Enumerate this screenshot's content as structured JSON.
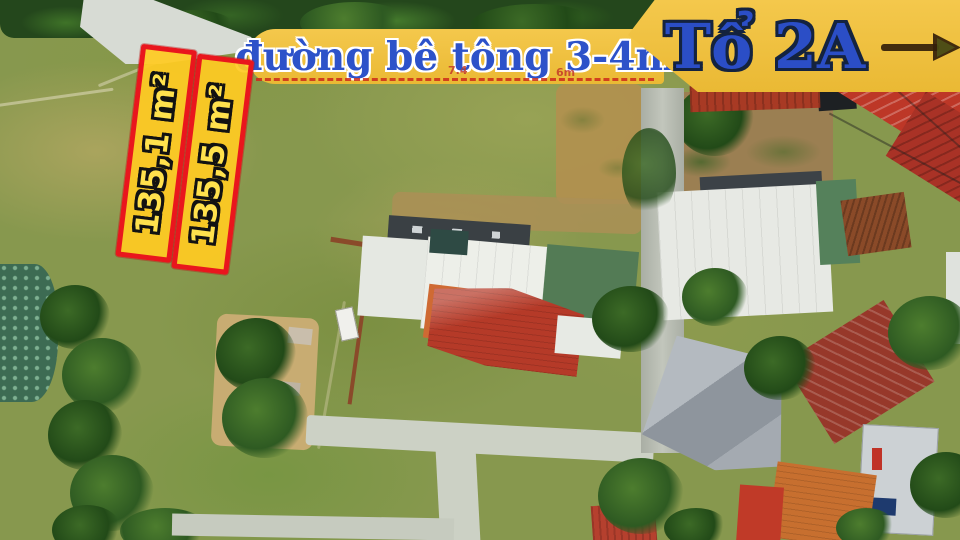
{
  "scene": {
    "type": "aerial-drone-photo",
    "description": "Top-down drone photo of two land plots for sale outlined in red and yellow, beside a concrete road, surrounded by grass fields, trees and houses with red, white and green roofs"
  },
  "road_banner": {
    "label": "đường bê tông 3-4m",
    "bg_color": "#F0C23F",
    "text_color": "#2D52C9",
    "outline_color": "#FFFFFF"
  },
  "area_banner": {
    "label": "Tổ 2A",
    "bg_color": "#F0C23F",
    "text_color": "#2B4EC6",
    "outline_color": "#14233F",
    "arrow_icon": "arrow-right-icon",
    "arrow_color": "#33200a"
  },
  "plots": {
    "border_color": "#E9161D",
    "fill_color": "#FFCA22",
    "label_color": "#FFE14D",
    "label_outline_color": "#121212",
    "items": [
      {
        "label": "135,1 m²"
      },
      {
        "label": "135,5 m²"
      }
    ]
  },
  "measurements": {
    "left": "7.4",
    "right": "6m",
    "color": "#C43B28"
  }
}
